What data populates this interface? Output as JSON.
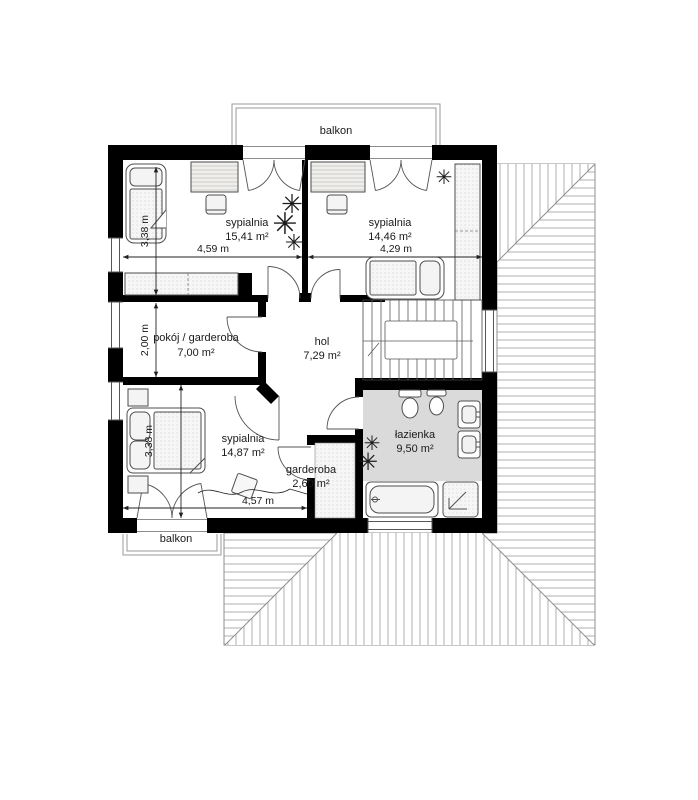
{
  "plan": {
    "title": "first floor plan",
    "rooms": [
      {
        "name": "sypialnia",
        "area": "15,41 m²"
      },
      {
        "name": "sypialnia",
        "area": "14,46 m²"
      },
      {
        "name": "pokój / garderoba",
        "area": "7,00 m²"
      },
      {
        "name": "hol",
        "area": "7,29 m²"
      },
      {
        "name": "sypialnia",
        "area": "14,87 m²"
      },
      {
        "name": "garderoba",
        "area": "2,60 m²"
      },
      {
        "name": "łazienka",
        "area": "9,50 m²"
      }
    ],
    "balconies": {
      "top": "balkon",
      "bottom": "balkon"
    },
    "dimensions": {
      "top_left_width": "4,59 m",
      "top_right_width": "4,29 m",
      "top_left_height": "3,38 m",
      "middle_left_height": "2,00 m",
      "bottom_left_height": "3,38 m",
      "bottom_width": "4,57 m"
    },
    "icons": {
      "plant": "✳"
    },
    "colors": {
      "wall": "#000000",
      "bath_floor": "#dadada",
      "roof_line": "#8f8f8f",
      "furniture_line": "#4d4d4d",
      "dimension_line": "#222222"
    }
  }
}
